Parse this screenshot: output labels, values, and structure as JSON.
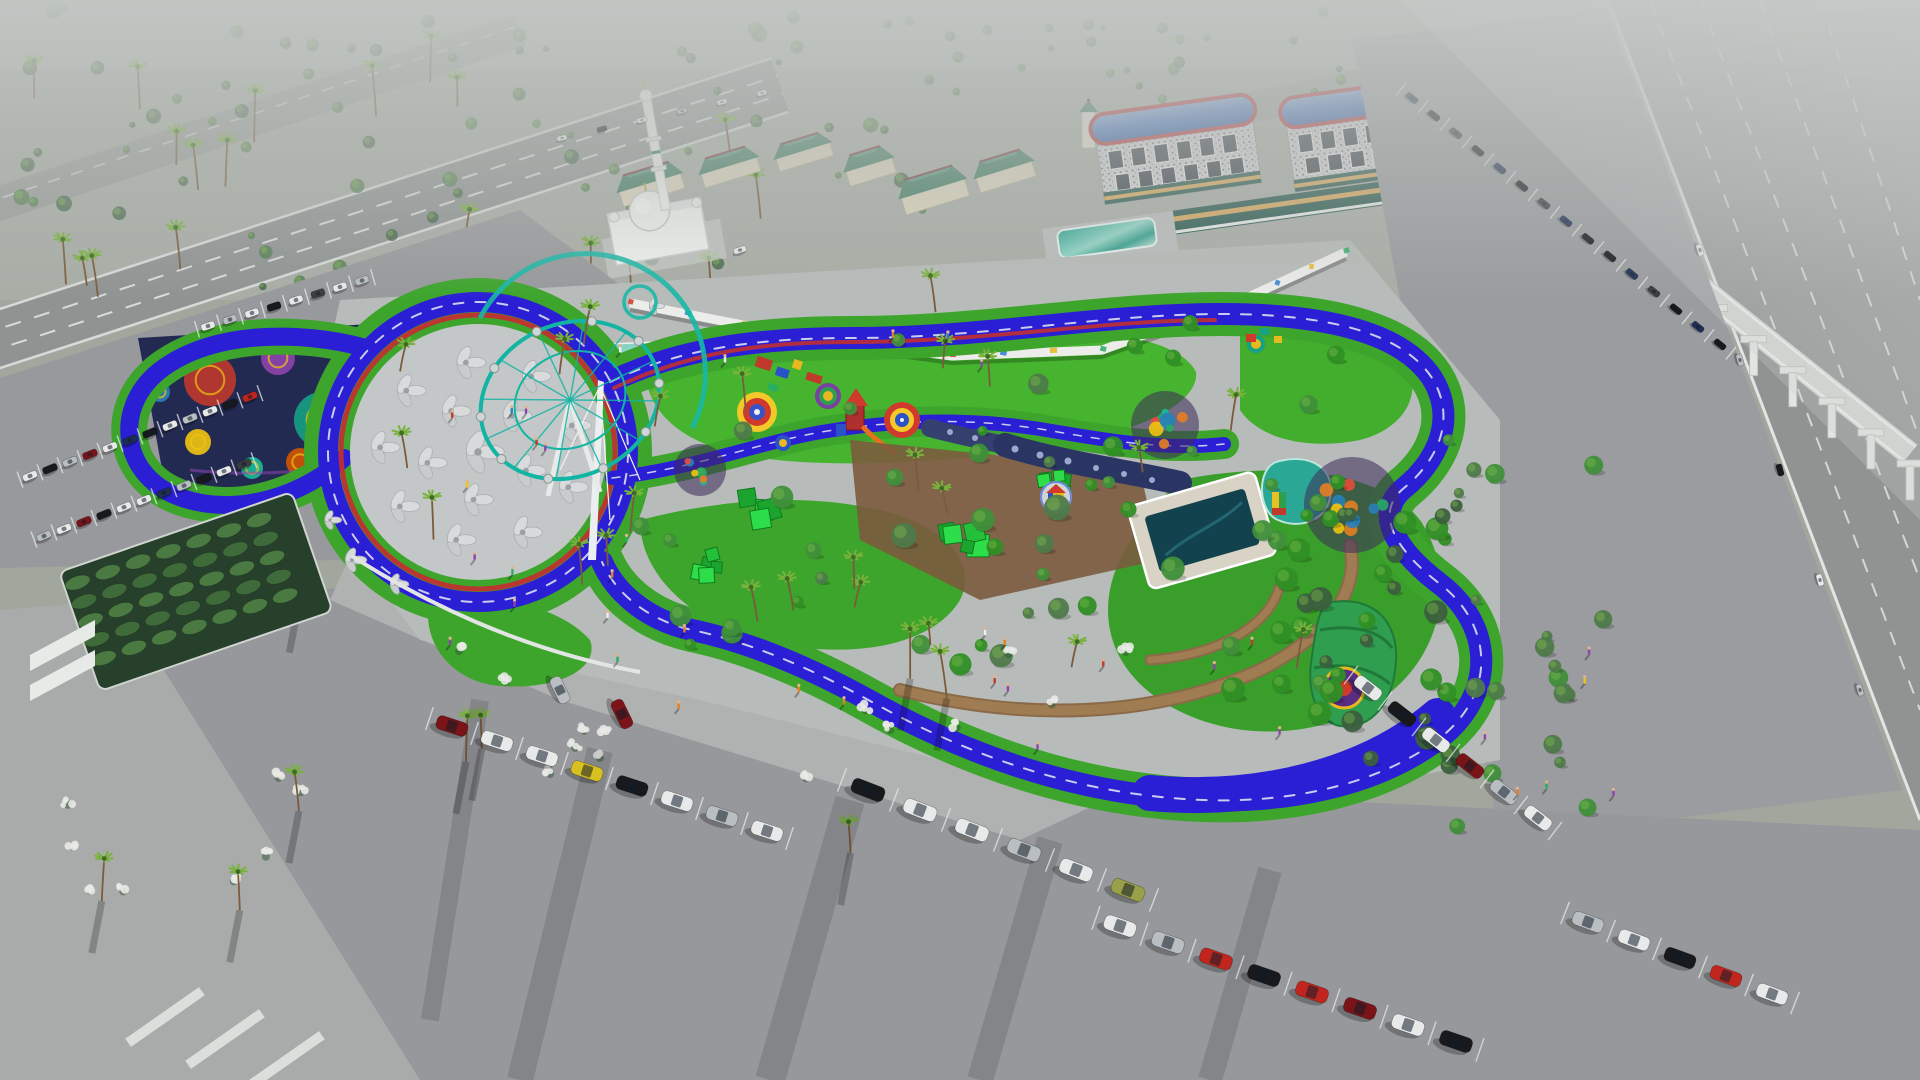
{
  "meta": {
    "title": "Aerial 3D architectural rendering of a family park and playground complex",
    "view": "aerial oblique, hazy daylight",
    "visible_text": "none"
  },
  "palette": {
    "ground_far": "#aab0ab",
    "ground_mid": "#a2a79e",
    "road": "#8f9493",
    "road_far": "#979c99",
    "parking": "#97999c",
    "parking_dark": "#8d8f92",
    "walk_light": "#b3b6b5",
    "plaza": "#b7bbb9",
    "track_blue": "#2b1fd6",
    "track_navy": "#191286",
    "accent_red": "#c03030",
    "line_white": "#eef0f2",
    "lawn": "#46b42e",
    "lawn_dark": "#2f8f25",
    "verge": "#3da52c",
    "teal_canopy": "#2ba693",
    "teal_light": "#bfe6da",
    "ferris_teal": "#12b5a3",
    "mosaic_bg": "#232a52",
    "navy_wall": "#2a3564",
    "voxel_green": "#23c13a",
    "pool_water": "#12424e",
    "deck_tan": "#d9d3c6",
    "boardwalk": "#8a6a49",
    "tree": "#4e7a4a",
    "tree_dark": "#3c5f3e",
    "park_tree": "#3f8f3a",
    "palm": "#79b23c",
    "palm_dark": "#3f6b22",
    "trunk": "#7a5c3c",
    "blossom": "#e9eae5",
    "bldg_beige": "#ded6bd",
    "roof_green": "#3f7d62",
    "roof_green_hi": "#54947c",
    "roof_ridge": "#7a3b3b",
    "hotel_roof": "#4a79c8",
    "hotel_roof_hi": "#7fa6e0",
    "hotel_red": "#b8383d",
    "facade": "#d5d6d8",
    "window_dark": "#39414a",
    "store_teal": "#2a5a50",
    "store_band": "#d8a85c",
    "apt_tan": "#c8b9a0",
    "apt_roof": "#8a4a3a",
    "mosque_white": "#eff1ef",
    "viaduct": "#d4d6d2",
    "pier": "#e3e5e1",
    "white": "#e8eaea",
    "black": "#17191c",
    "silver": "#b9bec2",
    "red": "#c0261d",
    "darkred": "#7a1418",
    "navy": "#1d2f55",
    "yellow": "#d8c020",
    "olive": "#9aa048",
    "darkgrey": "#3a3d40"
  },
  "annotations": [
    {
      "id": "mosque",
      "label": "white mosque with dome and tall minaret"
    },
    {
      "id": "green-roof-shops",
      "label": "commercial strip with beige walls and green hip roofs"
    },
    {
      "id": "hotels",
      "label": "two hotel blocks with curved blue metal roofs and red trim"
    },
    {
      "id": "gas-station",
      "label": "fuel station with teal canopy and red pumps"
    },
    {
      "id": "apartments",
      "label": "tan apartment blocks, north-east"
    },
    {
      "id": "monorail",
      "label": "elevated rail viaduct on white piers along highway"
    },
    {
      "id": "highway",
      "label": "multi-lane highway, right edge"
    },
    {
      "id": "jogging-track",
      "label": "royal-blue looping jogging track with red and white accents"
    },
    {
      "id": "mosaic-plaza",
      "label": "dark plaza with colorful mosaic circles, north-west"
    },
    {
      "id": "shade-canopy",
      "label": "teal wave shade canopy"
    },
    {
      "id": "ferris-wheel",
      "label": "tilted teal observation wheel"
    },
    {
      "id": "umbrella-plaza",
      "label": "circular plaza with petal shade umbrellas and white mast"
    },
    {
      "id": "playground",
      "label": "children playground: target circles, red slide tower, play units"
    },
    {
      "id": "climbing-walls",
      "label": "navy climbing walls with round holes"
    },
    {
      "id": "voxel-structures",
      "label": "green voxel climbing blocks"
    },
    {
      "id": "pool",
      "label": "square pool with pale deck"
    },
    {
      "id": "playhouse",
      "label": "small red-roofed playhouse on round pad"
    },
    {
      "id": "boardwalk",
      "label": "curved timber boardwalks"
    },
    {
      "id": "graffiti-wall",
      "label": "white wall with colorful graffiti, north boundary"
    },
    {
      "id": "parking",
      "label": "grey parking lots with angled stalls full of cars"
    },
    {
      "id": "hedge-garden",
      "label": "formal hedge garden, south-west"
    }
  ],
  "scene": {
    "vegetation": [
      {
        "id": "far-bushes",
        "region": [
          0,
          8,
          940,
          280
        ],
        "count": 80,
        "kind": "bush",
        "rmin": 3,
        "rmax": 8,
        "colors": [
          "tree_dark",
          "tree"
        ],
        "seed": 11,
        "opacity": 0.8
      },
      {
        "id": "far-bushes-right",
        "region": [
          950,
          8,
          420,
          110
        ],
        "count": 26,
        "kind": "bush",
        "rmin": 3,
        "rmax": 6,
        "colors": [
          "tree_dark",
          "tree"
        ],
        "seed": 12,
        "opacity": 0.7
      },
      {
        "id": "road-palms",
        "region": [
          10,
          80,
          780,
          240
        ],
        "count": 20,
        "kind": "palm",
        "hmin": 26,
        "hmax": 52,
        "seed": 13
      },
      {
        "id": "park-trees",
        "region": [
          630,
          320,
          760,
          420
        ],
        "count": 52,
        "kind": "tree",
        "rmin": 5,
        "rmax": 13,
        "colors": [
          "park_tree",
          "lawn_dark",
          "tree"
        ],
        "seed": 14
      },
      {
        "id": "east-grove",
        "region": [
          1280,
          470,
          190,
          300
        ],
        "count": 32,
        "kind": "tree",
        "rmin": 6,
        "rmax": 12,
        "colors": [
          "tree_dark",
          "lawn_dark"
        ],
        "seed": 15
      },
      {
        "id": "park-palms",
        "region": [
          340,
          300,
          1000,
          390
        ],
        "count": 24,
        "kind": "palm",
        "hmin": 22,
        "hmax": 46,
        "seed": 16
      },
      {
        "id": "south-blossoms",
        "region": [
          430,
          640,
          700,
          140
        ],
        "count": 14,
        "kind": "blossom",
        "seed": 17
      },
      {
        "id": "sw-blossoms",
        "region": [
          60,
          770,
          260,
          130
        ],
        "count": 8,
        "kind": "blossom",
        "seed": 18
      },
      {
        "id": "parking-palms",
        "region": [
          90,
          600,
          860,
          320
        ],
        "count": 9,
        "kind": "palm",
        "hmin": 30,
        "hmax": 55,
        "seed": 19,
        "shadow": true
      },
      {
        "id": "right-trees",
        "region": [
          1430,
          430,
          180,
          430
        ],
        "count": 20,
        "kind": "tree",
        "rmin": 5,
        "rmax": 10,
        "colors": [
          "tree",
          "park_tree"
        ],
        "seed": 20
      }
    ],
    "buildings": {
      "green_blocks": [
        {
          "x": 618,
          "y": 168,
          "w": 64,
          "h": 30,
          "rot": -17
        },
        {
          "x": 700,
          "y": 152,
          "w": 58,
          "h": 28,
          "rot": -17
        },
        {
          "x": 775,
          "y": 138,
          "w": 56,
          "h": 26,
          "rot": -17
        },
        {
          "x": 845,
          "y": 150,
          "w": 48,
          "h": 30,
          "rot": -17
        },
        {
          "x": 900,
          "y": 172,
          "w": 66,
          "h": 34,
          "rot": -17
        },
        {
          "x": 975,
          "y": 155,
          "w": 58,
          "h": 30,
          "rot": -17
        }
      ],
      "clock_tower": {
        "x": 1082,
        "y": 112,
        "w": 13,
        "h": 36
      },
      "hotels": [
        {
          "x": 1098,
          "y": 104,
          "w": 158,
          "h": 90,
          "rot": -8,
          "windows": 6
        },
        {
          "x": 1288,
          "y": 86,
          "w": 178,
          "h": 94,
          "rot": -8,
          "windows": 7
        }
      ],
      "retail_strip": {
        "x": 1088,
        "y": 196,
        "w": 380,
        "h": 24,
        "rot": -8
      },
      "apartments": [
        {
          "x": 1448,
          "y": 92,
          "w": 70,
          "h": 38,
          "rot": -8
        },
        {
          "x": 1496,
          "y": 118,
          "w": 72,
          "h": 36,
          "rot": -8
        },
        {
          "x": 1532,
          "y": 76,
          "w": 62,
          "h": 34,
          "rot": -8
        }
      ],
      "gas_station": {
        "x": 1058,
        "y": 224,
        "w": 98,
        "h": 28,
        "rot": -8,
        "pumps": 3
      }
    },
    "monorail": {
      "x1": 1402,
      "y1": 64,
      "x2": 1910,
      "y2": 468,
      "piers": 14
    },
    "graffiti": {
      "points": [
        [
          630,
          303
        ],
        [
          800,
          336
        ],
        [
          952,
          356
        ],
        [
          1102,
          350
        ],
        [
          1242,
          300
        ],
        [
          1346,
          252
        ]
      ],
      "ticks": 16,
      "colors": [
        "#d03a2c",
        "#2a7fd0",
        "#e8b820",
        "#27ae60",
        "#8e44ad",
        "#e8701a"
      ]
    },
    "park": {
      "targets": [
        {
          "x": 757,
          "y": 412,
          "rings": [
            [
              "#f2c928",
              20
            ],
            [
              "#d03a2c",
              14
            ],
            [
              "#3a53c4",
              8
            ],
            [
              "#f0f0f0",
              3
            ]
          ]
        },
        {
          "x": 828,
          "y": 396,
          "rings": [
            [
              "#7a3fa0",
              13
            ],
            [
              "#2e9e4f",
              9
            ],
            [
              "#e8b820",
              5
            ]
          ]
        },
        {
          "x": 902,
          "y": 420,
          "rings": [
            [
              "#d03a2c",
              18
            ],
            [
              "#f2c928",
              12
            ],
            [
              "#2a52c8",
              7
            ],
            [
              "#f0f0f0",
              2
            ]
          ]
        },
        {
          "x": 783,
          "y": 443,
          "rings": [
            [
              "#2a52c8",
              8
            ],
            [
              "#e8b820",
              4
            ]
          ]
        },
        {
          "x": 1256,
          "y": 344,
          "rings": [
            [
              "#16a085",
              9
            ],
            [
              "#e8b820",
              5
            ]
          ]
        }
      ],
      "mosaic_circles": [
        [
          210,
          380,
          26,
          "#c0392b"
        ],
        [
          278,
          358,
          17,
          "#8e44ad"
        ],
        [
          322,
          420,
          28,
          "#16a085"
        ],
        [
          198,
          442,
          13,
          "#f1c40f"
        ],
        [
          390,
          352,
          15,
          "#e74c3c"
        ],
        [
          422,
          430,
          21,
          "#9b59b6"
        ],
        [
          252,
          468,
          11,
          "#1abc9c"
        ],
        [
          352,
          386,
          12,
          "#e67e22"
        ],
        [
          160,
          392,
          10,
          "#2980b9"
        ],
        [
          300,
          462,
          14,
          "#d35400"
        ]
      ],
      "dot_patches": [
        {
          "x": 1352,
          "y": 505,
          "r": 48,
          "n": 14,
          "seed": 51
        },
        {
          "x": 1165,
          "y": 425,
          "r": 34,
          "n": 9,
          "seed": 52
        },
        {
          "x": 700,
          "y": 470,
          "r": 26,
          "n": 7,
          "seed": 53
        }
      ],
      "flowers": {
        "cx": 478,
        "cy": 452,
        "rings": [
          [
            0,
            1
          ],
          [
            52,
            5
          ],
          [
            98,
            9
          ]
        ],
        "extra": [
          [
            352,
            560,
            0.7
          ],
          [
            396,
            584,
            0.6
          ],
          [
            330,
            520,
            0.55
          ],
          [
            654,
            306,
            0.5
          ]
        ]
      },
      "ferris": {
        "cx": 570,
        "cy": 400,
        "rx": 92,
        "ry": 76,
        "rot": -25,
        "spokes": 12,
        "pods": 10
      },
      "voxels": [
        {
          "x": 745,
          "y": 502,
          "s": 26,
          "seed": 41
        },
        {
          "x": 952,
          "y": 524,
          "s": 30,
          "seed": 42
        },
        {
          "x": 1048,
          "y": 478,
          "s": 24,
          "seed": 43
        },
        {
          "x": 702,
          "y": 560,
          "s": 20,
          "seed": 44
        }
      ],
      "hedges": {
        "x": 88,
        "y": 545,
        "cols": 7,
        "rows": 5,
        "dx": 32,
        "dy": 20,
        "rot": -19,
        "ox": 195,
        "oy": 595
      }
    },
    "parking": {
      "rows": [
        {
          "id": "west-a",
          "x": 30,
          "y": 476,
          "dx": 20,
          "dy": -7.2,
          "w": 15,
          "h": 7,
          "angle": -22,
          "colors": [
            "white",
            "black",
            "silver",
            "darkred",
            "white",
            "navy",
            "black",
            "white",
            "silver",
            "white",
            "black",
            "red"
          ]
        },
        {
          "id": "west-b",
          "x": 44,
          "y": 536,
          "dx": 20,
          "dy": -7.2,
          "w": 15,
          "h": 7,
          "angle": -22,
          "colors": [
            "silver",
            "white",
            "darkred",
            "black",
            "white",
            "white",
            "navy",
            "silver",
            "black",
            "white",
            "darkgrey"
          ]
        },
        {
          "id": "west-road",
          "x": 208,
          "y": 326,
          "dx": 22,
          "dy": -6.5,
          "w": 14,
          "h": 7,
          "angle": -18,
          "colors": [
            "white",
            "silver",
            "white",
            "black",
            "white",
            "darkgrey",
            "white",
            "silver"
          ]
        },
        {
          "id": "top-road-traffic",
          "x": 562,
          "y": 138,
          "dx": 40,
          "dy": -9,
          "w": 10,
          "h": 5,
          "angle": -14,
          "nostall": true,
          "colors": [
            "white",
            "black",
            "white",
            "silver",
            "white",
            "white"
          ]
        },
        {
          "id": "viaduct",
          "x": 1412,
          "y": 98,
          "dx": 22,
          "dy": 17.6,
          "w": 13,
          "h": 6,
          "angle": 39,
          "colors": [
            "navy",
            "black",
            "darkgrey",
            "black",
            "navy",
            "black",
            "darkgrey",
            "navy",
            "black",
            "black",
            "navy",
            "darkgrey",
            "black",
            "navy",
            "black"
          ]
        },
        {
          "id": "south-1",
          "x": 452,
          "y": 726,
          "dx": 45,
          "dy": 15,
          "w": 32,
          "h": 14,
          "angle": 18,
          "colors": [
            "darkred",
            "white",
            "white",
            "yellow",
            "black",
            "white",
            "silver",
            "white"
          ]
        },
        {
          "id": "south-2",
          "x": 868,
          "y": 790,
          "dx": 52,
          "dy": 20,
          "w": 34,
          "h": 15,
          "angle": 21,
          "colors": [
            "black",
            "white",
            "white",
            "silver",
            "white",
            "olive"
          ]
        },
        {
          "id": "south-3",
          "x": 1120,
          "y": 926,
          "dx": 48,
          "dy": 16.5,
          "w": 33,
          "h": 15,
          "angle": 19,
          "colors": [
            "white",
            "silver",
            "red",
            "black",
            "red",
            "darkred",
            "white",
            "black"
          ]
        },
        {
          "id": "south-4",
          "x": 1368,
          "y": 688,
          "dx": 34,
          "dy": 26,
          "w": 30,
          "h": 13,
          "angle": 38,
          "colors": [
            "white",
            "black",
            "white",
            "darkred",
            "silver",
            "white"
          ]
        },
        {
          "id": "south-5",
          "x": 1588,
          "y": 922,
          "dx": 46,
          "dy": 18,
          "w": 32,
          "h": 14,
          "angle": 20,
          "colors": [
            "silver",
            "white",
            "black",
            "red",
            "white"
          ]
        },
        {
          "id": "hwy-traffic",
          "x": 1700,
          "y": 250,
          "dx": 40,
          "dy": 110,
          "w": 12,
          "h": 6,
          "angle": 74,
          "nostall": true,
          "colors": [
            "white",
            "silver",
            "black",
            "white",
            "silver"
          ]
        }
      ],
      "singles": [
        {
          "x": 622,
          "y": 714,
          "angle": 64,
          "w": 30,
          "h": 13,
          "color": "darkred"
        },
        {
          "x": 560,
          "y": 690,
          "angle": 64,
          "w": 28,
          "h": 12,
          "color": "silver"
        },
        {
          "x": 740,
          "y": 250,
          "angle": -18,
          "w": 13,
          "h": 6,
          "color": "white"
        }
      ]
    },
    "people": {
      "colors": [
        "#c0392b",
        "#2980b9",
        "#e67e22",
        "#ecf0f1",
        "#27ae60",
        "#8e44ad",
        "#f1c40f"
      ],
      "regions": [
        {
          "region": [
            420,
            410,
            130,
            90
          ],
          "n": 6,
          "seed": 31
        },
        {
          "region": [
            420,
            540,
            220,
            110
          ],
          "n": 7,
          "seed": 32
        },
        {
          "region": [
            560,
            600,
            500,
            120
          ],
          "n": 8,
          "seed": 33
        },
        {
          "region": [
            900,
            640,
            380,
            120
          ],
          "n": 6,
          "seed": 34
        },
        {
          "region": [
            1440,
            640,
            180,
            220
          ],
          "n": 6,
          "seed": 35
        },
        {
          "region": [
            620,
            330,
            420,
            60
          ],
          "n": 5,
          "seed": 36
        }
      ]
    },
    "shadow_streaks": [
      [
        600,
        750,
        520,
        1080,
        26
      ],
      [
        850,
        800,
        770,
        1080,
        30
      ],
      [
        1050,
        840,
        980,
        1080,
        26
      ],
      [
        1270,
        870,
        1210,
        1080,
        24
      ],
      [
        480,
        700,
        430,
        1020,
        18
      ]
    ]
  }
}
